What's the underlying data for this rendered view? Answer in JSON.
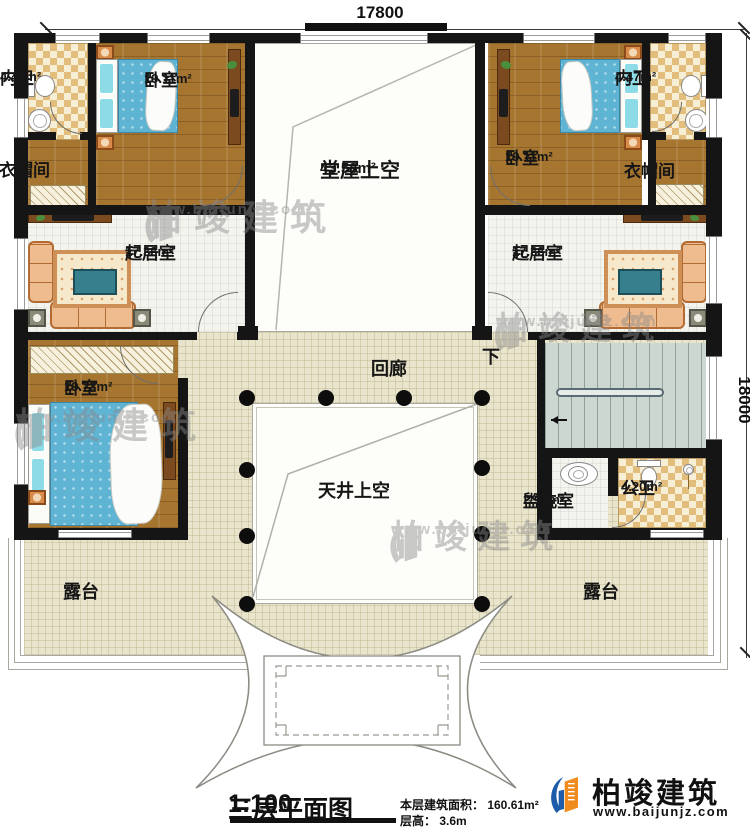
{
  "dimensions": {
    "width_top": "17800",
    "height_right": "18000"
  },
  "rooms": {
    "bath_left": {
      "name": "内卫",
      "area": "4.47m²"
    },
    "bedroom_top_left": {
      "name": "卧室",
      "area": "19.11m²"
    },
    "closet_left": {
      "name": "衣帽间"
    },
    "hall_void": {
      "name": "堂屋上空",
      "area": "43.58m²"
    },
    "bedroom_top_right": {
      "name": "卧室",
      "area": "19.11m²"
    },
    "bath_right": {
      "name": "内卫",
      "area": "4.47m²"
    },
    "closet_right": {
      "name": "衣帽间"
    },
    "living_left": {
      "name": "起居室",
      "area": "17.33m²"
    },
    "living_right": {
      "name": "起居室",
      "area": "17.33m²"
    },
    "bedroom_mid_left": {
      "name": "卧室",
      "area": "19.73m²"
    },
    "corridor": {
      "name": "回廊"
    },
    "stair_down": {
      "label": "下"
    },
    "courtyard_void": {
      "name": "天井上空"
    },
    "washroom": {
      "name": "盥洗室",
      "area": "2.91m²"
    },
    "bath_public": {
      "name": "公卫",
      "area": "4.20m²"
    },
    "terrace_left": {
      "name": "露台"
    },
    "terrace_right": {
      "name": "露台"
    }
  },
  "titleblock": {
    "title": "三层平面图",
    "scale": "1:100",
    "area_note": "本层建筑面积： 160.61m²",
    "floor_height_note": "层高： 3.6m"
  },
  "logo": {
    "company": "柏竣建筑",
    "website": "www.baijunjz.com"
  },
  "watermark": {
    "text": "柏竣建筑",
    "website": "www.baijunjz.com"
  }
}
